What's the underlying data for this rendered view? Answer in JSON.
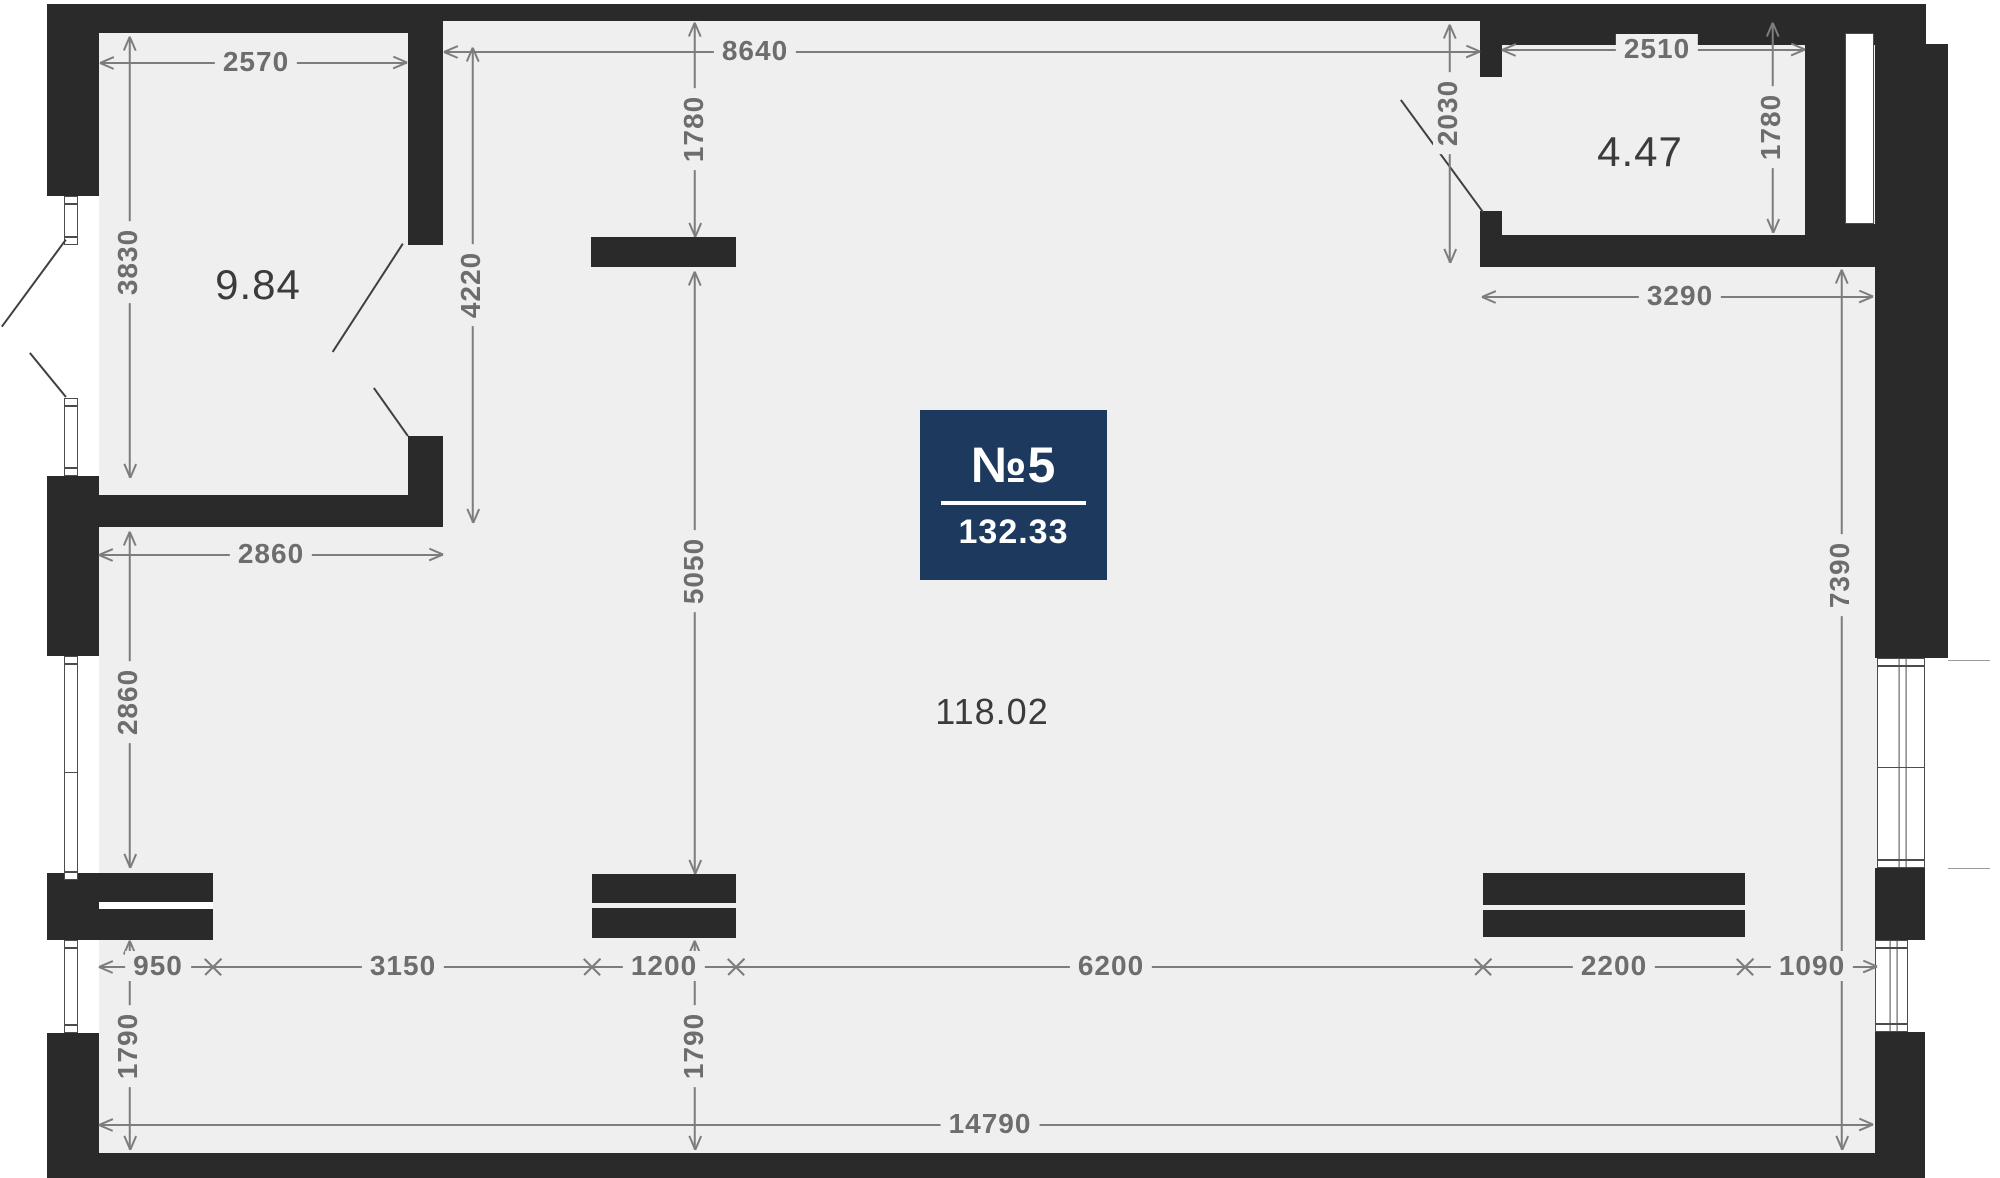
{
  "canvas": {
    "width": 2000,
    "height": 1178
  },
  "colors": {
    "outside": "#ffffff",
    "floor": "#efefef",
    "wall": "#2a2a2b",
    "dim_line": "#7d7d7d",
    "dim_text": "#6d6d6d",
    "area_text": "#3b3b3b",
    "swing": "#3f3f3f",
    "window_border": "#4c4c4c",
    "window_fill": "#ffffff",
    "extension_line": "#9a9a9a",
    "badge_bg": "#1d3a5e",
    "badge_text": "#ffffff"
  },
  "badge": {
    "number_label": "№5",
    "total_area": "132.33",
    "x": 920,
    "y": 410,
    "w": 187,
    "h": 170
  },
  "floor": {
    "x": 99,
    "y": 21,
    "w": 1778,
    "h": 1132
  },
  "area_labels": [
    {
      "name": "area-label-room-1",
      "text": "9.84",
      "x": 258,
      "y": 285,
      "size": 42
    },
    {
      "name": "area-label-room-2",
      "text": "4.47",
      "x": 1640,
      "y": 152,
      "size": 42
    },
    {
      "name": "area-label-main-room",
      "text": "118.02",
      "x": 992,
      "y": 712,
      "size": 36
    }
  ],
  "walls": [
    {
      "name": "top-wall-left",
      "x": 47,
      "y": 4,
      "w": 396,
      "h": 29
    },
    {
      "name": "top-wall-middle",
      "x": 443,
      "y": 4,
      "w": 1059,
      "h": 17
    },
    {
      "name": "top-wall-right",
      "x": 1502,
      "y": 4,
      "w": 424,
      "h": 41
    },
    {
      "name": "left-wall-upper",
      "x": 47,
      "y": 33,
      "w": 52,
      "h": 163
    },
    {
      "name": "left-wall-mid",
      "x": 47,
      "y": 476,
      "w": 52,
      "h": 180
    },
    {
      "name": "left-wall-lower",
      "x": 47,
      "y": 1033,
      "w": 52,
      "h": 145
    },
    {
      "name": "bottom-wall",
      "x": 47,
      "y": 1153,
      "w": 1878,
      "h": 25
    },
    {
      "name": "room1-right-wall",
      "x": 408,
      "y": 33,
      "w": 35,
      "h": 212
    },
    {
      "name": "room1-door-stub",
      "x": 408,
      "y": 436,
      "w": 35,
      "h": 91
    },
    {
      "name": "wall-under-room1",
      "x": 99,
      "y": 495,
      "w": 344,
      "h": 32
    },
    {
      "name": "shaft-block",
      "x": 591,
      "y": 237,
      "w": 145,
      "h": 30
    },
    {
      "name": "cabinet-left",
      "x": 47,
      "y": 873,
      "w": 166,
      "h": 67
    },
    {
      "name": "cabinet-center-a",
      "x": 592,
      "y": 874,
      "w": 144,
      "h": 29
    },
    {
      "name": "cabinet-center-b",
      "x": 592,
      "y": 908,
      "w": 144,
      "h": 30
    },
    {
      "name": "cabinet-right-a",
      "x": 1483,
      "y": 873,
      "w": 262,
      "h": 32
    },
    {
      "name": "cabinet-right-b",
      "x": 1483,
      "y": 910,
      "w": 262,
      "h": 27
    },
    {
      "name": "hall-stub-top",
      "x": 1480,
      "y": 21,
      "w": 22,
      "h": 56
    },
    {
      "name": "hall-stub-bottom",
      "x": 1480,
      "y": 211,
      "w": 22,
      "h": 24
    },
    {
      "name": "room2-bottom-wall",
      "x": 1480,
      "y": 235,
      "w": 395,
      "h": 32
    },
    {
      "name": "room2-right-wall",
      "x": 1805,
      "y": 45,
      "w": 40,
      "h": 190
    },
    {
      "name": "right-wall-upper",
      "x": 1875,
      "y": 44,
      "w": 73,
      "h": 614
    },
    {
      "name": "right-slot-fill",
      "x": 1845,
      "y": 224,
      "w": 30,
      "h": 43
    },
    {
      "name": "right-wall-mid",
      "x": 1875,
      "y": 868,
      "w": 50,
      "h": 72
    },
    {
      "name": "right-wall-lower",
      "x": 1875,
      "y": 1032,
      "w": 50,
      "h": 146
    }
  ],
  "whiteouts": [
    {
      "name": "cabinet-left-slit",
      "x": 99,
      "y": 902,
      "w": 114,
      "h": 7,
      "color": "#ffffff"
    }
  ],
  "windows": [
    {
      "name": "window-left-1",
      "x": 64,
      "y": 196,
      "w": 14,
      "h": 49,
      "o": "v",
      "mullion": false
    },
    {
      "name": "window-left-2",
      "x": 64,
      "y": 398,
      "w": 14,
      "h": 78,
      "o": "v",
      "mullion": false
    },
    {
      "name": "window-left-3",
      "x": 64,
      "y": 656,
      "w": 14,
      "h": 224,
      "o": "v",
      "mullion": false
    },
    {
      "name": "window-left-4",
      "x": 64,
      "y": 940,
      "w": 14,
      "h": 93,
      "o": "v",
      "mullion": false
    },
    {
      "name": "window-right-slot",
      "x": 1845,
      "y": 33,
      "w": 29,
      "h": 191,
      "o": "plain",
      "mullion": false
    },
    {
      "name": "window-right-mid",
      "x": 1877,
      "y": 658,
      "w": 48,
      "h": 210,
      "o": "v",
      "mullion": true
    },
    {
      "name": "window-right-low",
      "x": 1875,
      "y": 940,
      "w": 33,
      "h": 92,
      "o": "v",
      "mullion": true
    }
  ],
  "swing_lines": [
    {
      "name": "door-swing-bay-upper",
      "x1": 66,
      "y1": 240,
      "x2": 2,
      "y2": 327
    },
    {
      "name": "door-swing-bay-lower",
      "x1": 30,
      "y1": 353,
      "x2": 66,
      "y2": 397
    },
    {
      "name": "door-swing-room1-a",
      "x1": 403,
      "y1": 244,
      "x2": 333,
      "y2": 352
    },
    {
      "name": "door-swing-room1-b",
      "x1": 374,
      "y1": 388,
      "x2": 408,
      "y2": 436
    },
    {
      "name": "door-swing-entry",
      "x1": 1401,
      "y1": 100,
      "x2": 1483,
      "y2": 212
    }
  ],
  "extension_lines": [
    {
      "name": "ext-right-upper",
      "x1": 1948,
      "y1": 660,
      "x2": 1990,
      "y2": 660
    },
    {
      "name": "ext-right-lower",
      "x1": 1948,
      "y1": 868,
      "x2": 1990,
      "y2": 868
    }
  ],
  "dimensions": [
    {
      "name": "dim-2570",
      "label": "2570",
      "dir": "h",
      "a": 100,
      "b": 407,
      "pos": 63,
      "lx": 256,
      "ly": 62,
      "m1": "arrow",
      "m2": "arrow"
    },
    {
      "name": "dim-8640",
      "label": "8640",
      "dir": "h",
      "a": 444,
      "b": 1480,
      "pos": 52,
      "lx": 755,
      "ly": 51,
      "m1": "arrow",
      "m2": "arrow"
    },
    {
      "name": "dim-2510",
      "label": "2510",
      "dir": "h",
      "a": 1502,
      "b": 1805,
      "pos": 50,
      "lx": 1657,
      "ly": 49,
      "m1": "arrow",
      "m2": "arrow"
    },
    {
      "name": "dim-1780-center",
      "label": "1780",
      "dir": "v",
      "a": 23,
      "b": 237,
      "pos": 695,
      "lx": 694,
      "ly": 129,
      "m1": "arrow",
      "m2": "arrow"
    },
    {
      "name": "dim-4220",
      "label": "4220",
      "dir": "v",
      "a": 48,
      "b": 523,
      "pos": 473,
      "lx": 471,
      "ly": 285,
      "m1": "arrow",
      "m2": "arrow"
    },
    {
      "name": "dim-5050",
      "label": "5050",
      "dir": "v",
      "a": 272,
      "b": 874,
      "pos": 695,
      "lx": 694,
      "ly": 571,
      "m1": "arrow",
      "m2": "arrow"
    },
    {
      "name": "dim-2030",
      "label": "2030",
      "dir": "v",
      "a": 25,
      "b": 263,
      "pos": 1450,
      "lx": 1448,
      "ly": 113,
      "m1": "arrow",
      "m2": "arrow"
    },
    {
      "name": "dim-1780-right",
      "label": "1780",
      "dir": "v",
      "a": 23,
      "b": 233,
      "pos": 1773,
      "lx": 1771,
      "ly": 127,
      "m1": "arrow",
      "m2": "arrow"
    },
    {
      "name": "dim-3830",
      "label": "3830",
      "dir": "v",
      "a": 37,
      "b": 478,
      "pos": 130,
      "lx": 128,
      "ly": 262,
      "m1": "arrow",
      "m2": "arrow"
    },
    {
      "name": "dim-3290",
      "label": "3290",
      "dir": "h",
      "a": 1482,
      "b": 1873,
      "pos": 297,
      "lx": 1680,
      "ly": 296,
      "m1": "arrow",
      "m2": "arrow"
    },
    {
      "name": "dim-2860-h",
      "label": "2860",
      "dir": "h",
      "a": 99,
      "b": 443,
      "pos": 555,
      "lx": 271,
      "ly": 554,
      "m1": "arrow",
      "m2": "arrow"
    },
    {
      "name": "dim-2860-v",
      "label": "2860",
      "dir": "v",
      "a": 532,
      "b": 868,
      "pos": 130,
      "lx": 128,
      "ly": 702,
      "m1": "arrow",
      "m2": "arrow"
    },
    {
      "name": "dim-7390",
      "label": "7390",
      "dir": "v",
      "a": 270,
      "b": 1150,
      "pos": 1842,
      "lx": 1840,
      "ly": 575,
      "m1": "arrow",
      "m2": "arrow"
    },
    {
      "name": "dim-950",
      "label": "950",
      "dir": "h",
      "a": 99,
      "b": 213,
      "pos": 967,
      "lx": 158,
      "ly": 966,
      "m1": "arrow",
      "m2": "cross"
    },
    {
      "name": "dim-3150",
      "label": "3150",
      "dir": "h",
      "a": 213,
      "b": 592,
      "pos": 967,
      "lx": 403,
      "ly": 966,
      "m1": "cross",
      "m2": "cross"
    },
    {
      "name": "dim-1200",
      "label": "1200",
      "dir": "h",
      "a": 592,
      "b": 736,
      "pos": 967,
      "lx": 664,
      "ly": 966,
      "m1": "cross",
      "m2": "cross"
    },
    {
      "name": "dim-6200",
      "label": "6200",
      "dir": "h",
      "a": 736,
      "b": 1483,
      "pos": 967,
      "lx": 1111,
      "ly": 966,
      "m1": "cross",
      "m2": "cross"
    },
    {
      "name": "dim-2200",
      "label": "2200",
      "dir": "h",
      "a": 1483,
      "b": 1745,
      "pos": 967,
      "lx": 1614,
      "ly": 966,
      "m1": "cross",
      "m2": "cross"
    },
    {
      "name": "dim-1090",
      "label": "1090",
      "dir": "h",
      "a": 1745,
      "b": 1877,
      "pos": 967,
      "lx": 1812,
      "ly": 966,
      "m1": "cross",
      "m2": "arrow"
    },
    {
      "name": "dim-1790-left",
      "label": "1790",
      "dir": "v",
      "a": 941,
      "b": 1150,
      "pos": 130,
      "lx": 128,
      "ly": 1046,
      "m1": "arrow",
      "m2": "arrow"
    },
    {
      "name": "dim-1790-center",
      "label": "1790",
      "dir": "v",
      "a": 941,
      "b": 1150,
      "pos": 695,
      "lx": 694,
      "ly": 1046,
      "m1": "arrow",
      "m2": "arrow"
    },
    {
      "name": "dim-14790",
      "label": "14790",
      "dir": "h",
      "a": 99,
      "b": 1873,
      "pos": 1125,
      "lx": 990,
      "ly": 1124,
      "m1": "arrow",
      "m2": "arrow"
    }
  ]
}
